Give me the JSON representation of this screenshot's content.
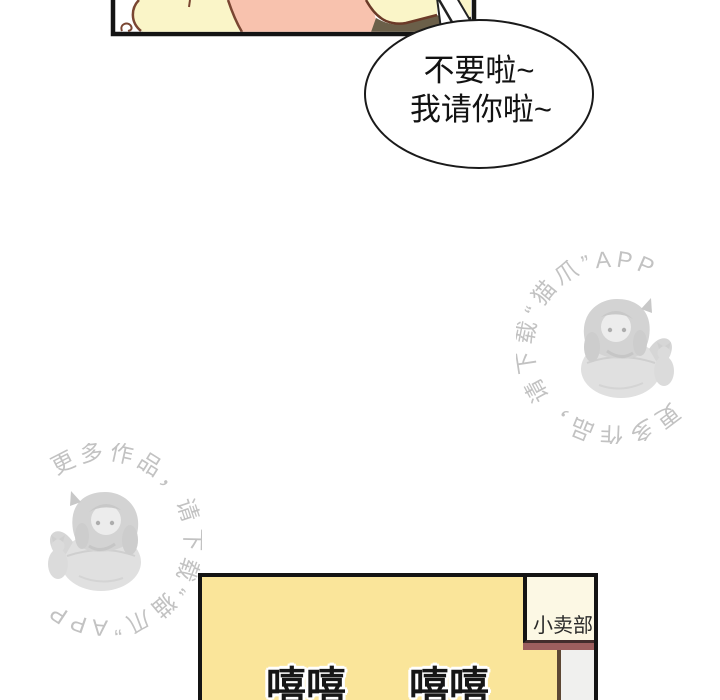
{
  "comic": {
    "speech_bubble": {
      "line1": "不要啦~",
      "line2": "我请你啦~"
    },
    "watermark": {
      "text": "更多作品，请下载“猫爪”APP",
      "app_name": "猫爪"
    },
    "shop_panel": {
      "sign_label": "小卖部",
      "sfx": [
        "嘻嘻",
        "嘻嘻"
      ]
    },
    "colors": {
      "skin_cream": "#FAF5C8",
      "shirt_pink": "#F8C2AE",
      "shadow_olive": "#6B5F49",
      "outline_brown": "#7A4632",
      "wall_yellow": "#FAE59A",
      "sign_cream": "#FCF8E4",
      "awning_maroon": "#9D5E5E",
      "door_gray": "#F0F0EE",
      "watermark_gray": "#C2C2C2",
      "ink_black": "#141414"
    }
  }
}
